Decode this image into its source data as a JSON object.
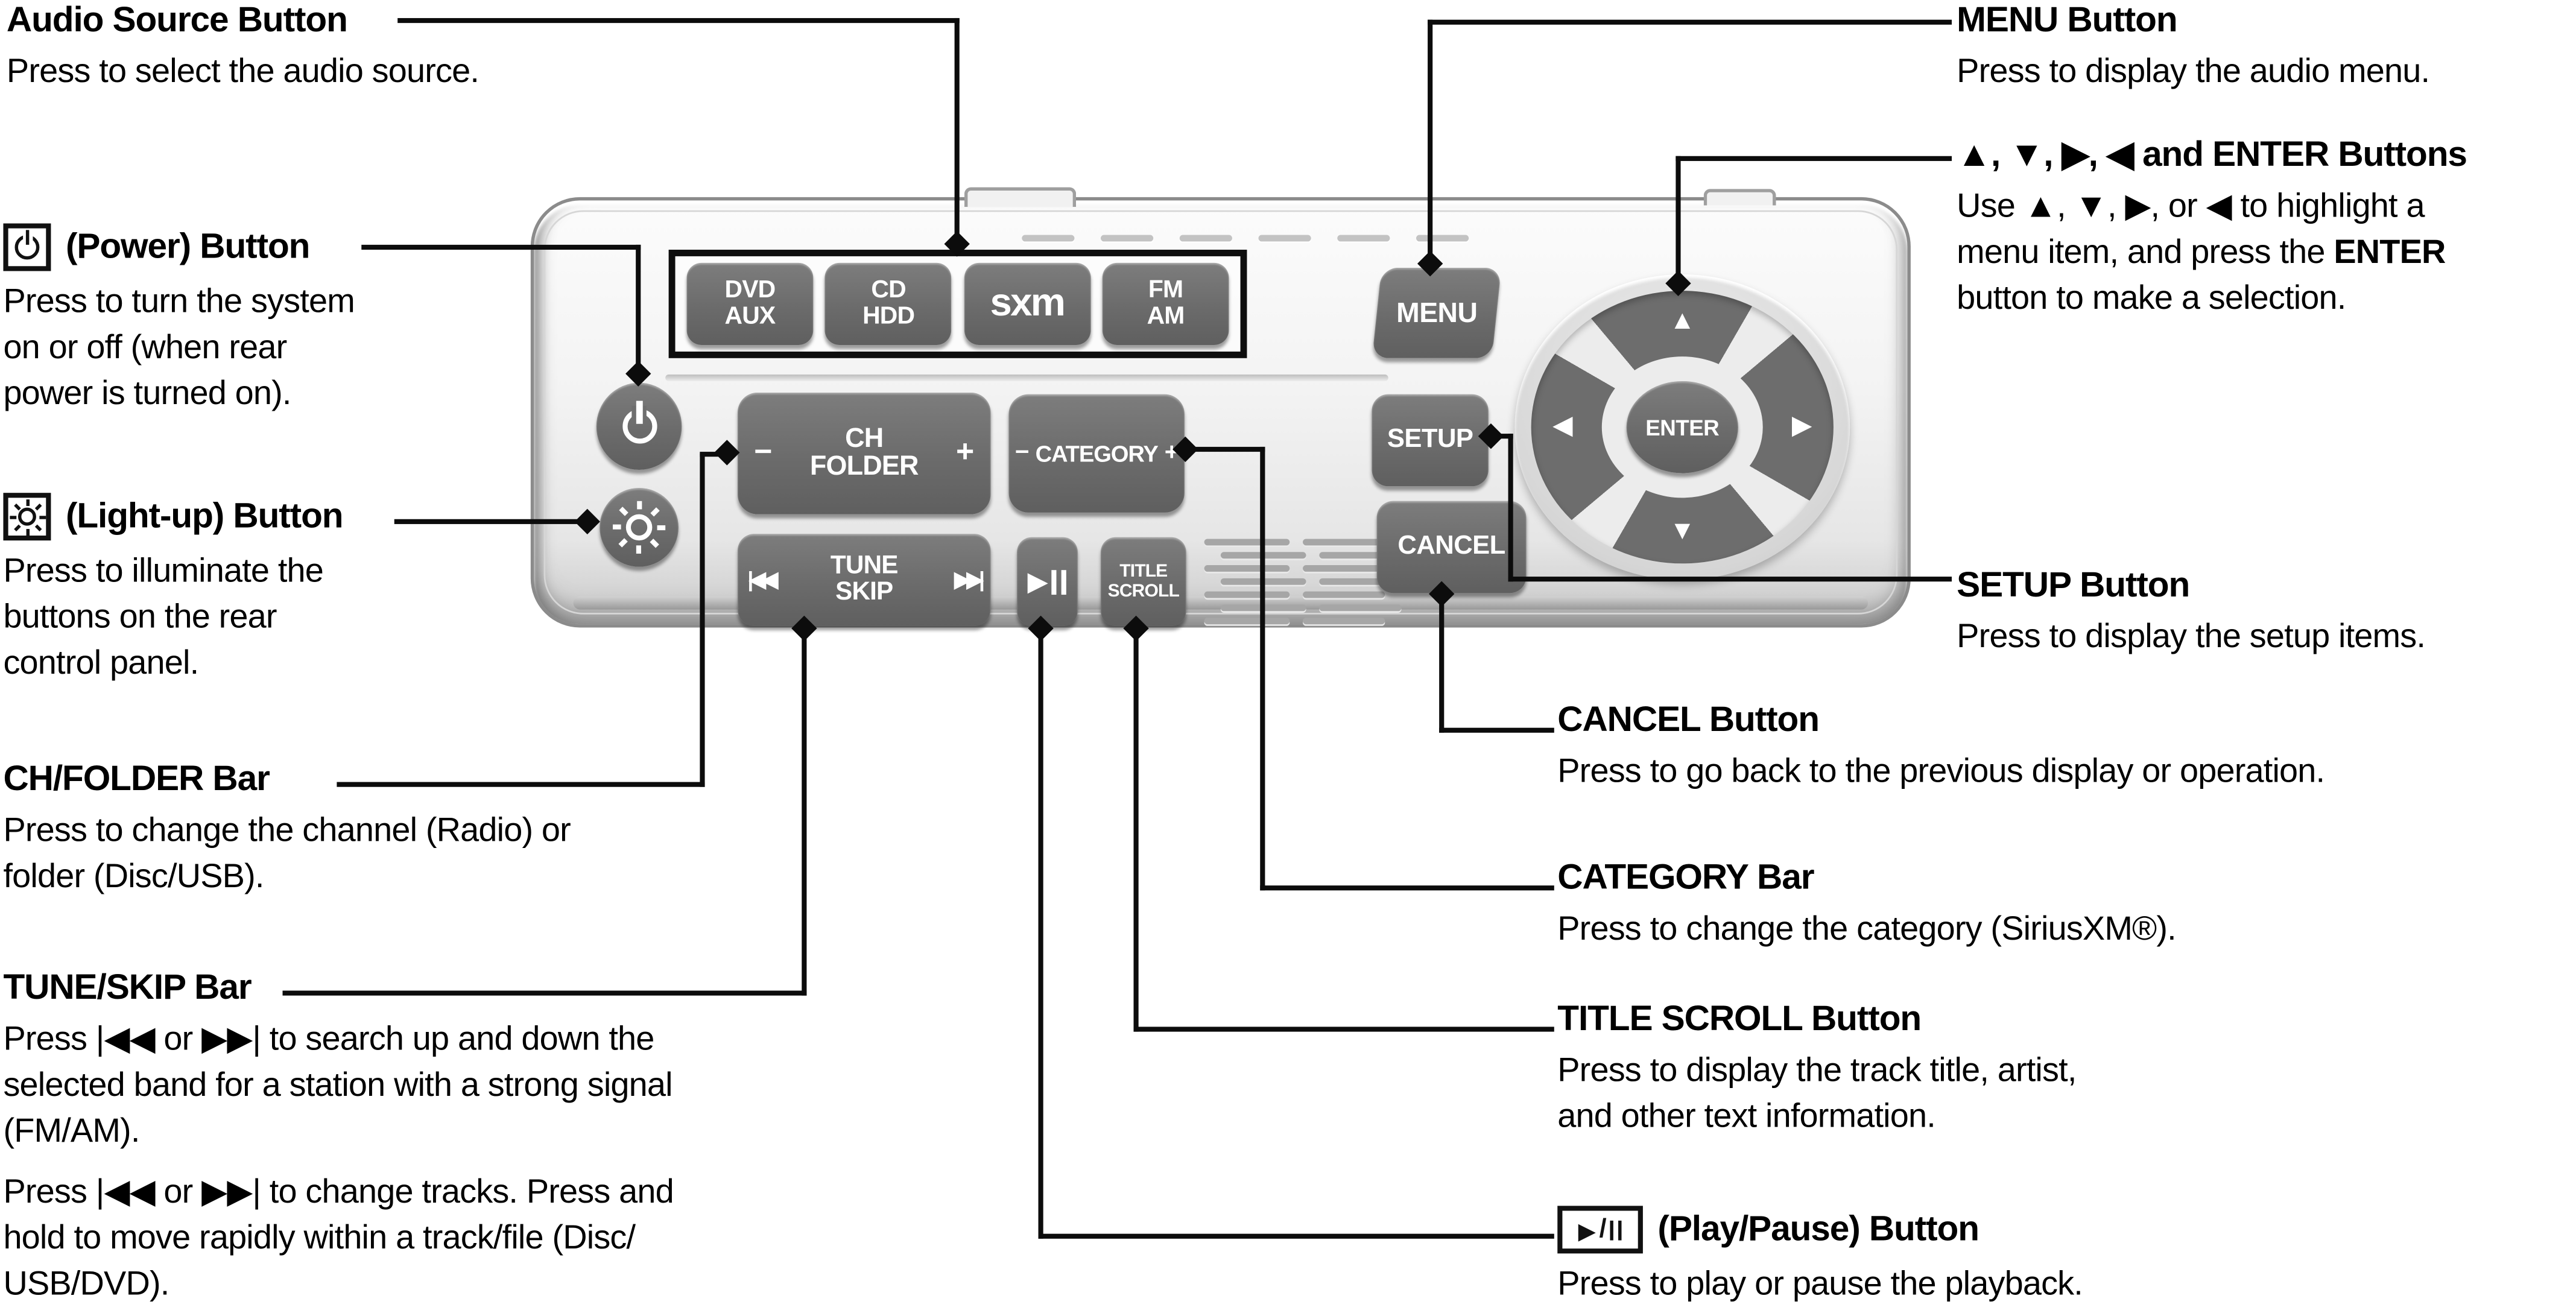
{
  "colors": {
    "button_gray": "#6e6e6e",
    "panel_face": "#f3f3f3",
    "callout_line": "#0c0c0c",
    "text": "#000000"
  },
  "icons": {
    "power": "power-icon",
    "light_up": "light-bulb-icon",
    "play_pause": "play-pause-icon",
    "skip_back_glyph": "|◀◀",
    "skip_forward_glyph": "▶▶|",
    "play_glyph": "▶"
  },
  "panel": {
    "source_buttons": [
      {
        "top": "DVD",
        "bottom": "AUX"
      },
      {
        "top": "CD",
        "bottom": "HDD"
      },
      {
        "logo": "sxm"
      },
      {
        "top": "FM",
        "bottom": "AM"
      }
    ],
    "ch_folder_bar": {
      "minus": "−",
      "top": "CH",
      "bottom": "FOLDER",
      "plus": "+"
    },
    "category_bar": {
      "minus": "−",
      "label": "CATEGORY",
      "plus": "+"
    },
    "tune_skip_bar": {
      "left": "|◀◀",
      "top": "TUNE",
      "bottom": "SKIP",
      "right": "▶▶|"
    },
    "play_pause_button": {
      "play": "▶"
    },
    "title_scroll_button": {
      "top": "TITLE",
      "bottom": "SCROLL"
    },
    "menu_button": "MENU",
    "setup_button": "SETUP",
    "cancel_button": "CANCEL",
    "enter_button": "ENTER",
    "dpad": {
      "up": "▲",
      "down": "▼",
      "left": "◀",
      "right": "▶"
    }
  },
  "callouts": {
    "audio_source": {
      "title": "Audio Source Button",
      "line1": "Press to select the audio source."
    },
    "power": {
      "title": "(Power) Button",
      "line1": "Press to turn the system",
      "line2": "on or off (when rear",
      "line3": "power is turned on)."
    },
    "light_up": {
      "title": "(Light-up) Button",
      "line1": "Press to illuminate the",
      "line2": "buttons on the rear",
      "line3": "control panel."
    },
    "ch_folder": {
      "title": "CH/FOLDER Bar",
      "line1": "Press to change the channel (Radio) or",
      "line2": "folder (Disc/USB)."
    },
    "tune_skip": {
      "title": "TUNE/SKIP Bar",
      "p1_line1": "Press |◀◀ or ▶▶| to search up and down the",
      "p1_line2": "selected band for a station with a strong signal",
      "p1_line3": "(FM/AM).",
      "p2_line1": "Press |◀◀ or ▶▶| to change tracks. Press and",
      "p2_line2": "hold to move rapidly within a track/file (Disc/",
      "p2_line3": "USB/DVD)."
    },
    "menu": {
      "title": "MENU Button",
      "line1": "Press to display the audio menu."
    },
    "arrows_enter": {
      "title": "▲, ▼, ▶, ◀ and ENTER Buttons",
      "line1": "Use ▲, ▼, ▶, or ◀ to highlight a",
      "line2_pre": "menu item, and press the ",
      "line2_bold": "ENTER",
      "line3": "button to make a selection."
    },
    "setup": {
      "title": "SETUP Button",
      "line1": "Press to display the setup items."
    },
    "cancel": {
      "title": "CANCEL Button",
      "line1": "Press to go back to the previous display or operation."
    },
    "category": {
      "title": "CATEGORY Bar",
      "line1": "Press to change the category (SiriusXM®)."
    },
    "title_scroll": {
      "title": "TITLE SCROLL Button",
      "line1": "Press to display the track title, artist,",
      "line2": "and other text information."
    },
    "play_pause": {
      "title": "(Play/Pause) Button",
      "line1": "Press to play or pause the playback."
    }
  }
}
